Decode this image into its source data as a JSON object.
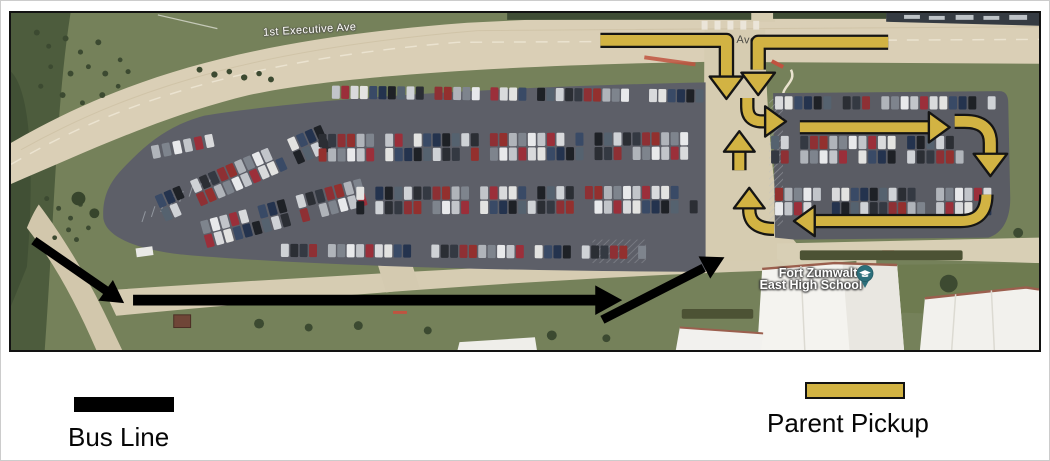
{
  "map": {
    "street_labels": [
      {
        "text": "1st Executive Ave"
      },
      {
        "text": "1st Executive Ave"
      }
    ],
    "school": {
      "line1": "Fort Zumwalt",
      "line2": "East High School",
      "pin_icon": "graduation-cap-pin",
      "pin_color": "#2c6f7b"
    }
  },
  "legend": {
    "bus": {
      "label": "Bus Line"
    },
    "parent_pickup": {
      "label": "Parent Pickup"
    }
  },
  "routes": {
    "bus_line": {
      "color": "#000000",
      "arrows": [
        {
          "name": "approach-from-west",
          "path": "M 23,233 L 97,285",
          "tip": [
            114,
            297
          ],
          "dir": 35,
          "width": 9
        },
        {
          "name": "bus-lane-eastbound",
          "path": "M 123,294 L 592,294",
          "tip": [
            616,
            294
          ],
          "dir": 0,
          "width": 11
        },
        {
          "name": "turn-toward-school",
          "path": "M 596,314 L 698,261",
          "tip": [
            719,
            250
          ],
          "dir": -27.5,
          "width": 9
        }
      ]
    },
    "parent_pickup": {
      "color": "#d2b343",
      "outline": "#151515",
      "arrows": [
        {
          "name": "entry-from-west",
          "path": "M 594,28 L 721,28 L 721,64",
          "tip": [
            721,
            88
          ],
          "dir": 90,
          "width": 11
        },
        {
          "name": "entry-from-east",
          "path": "M 884,30 L 753,30 L 753,58",
          "tip": [
            753,
            84
          ],
          "dir": 90,
          "width": 11
        },
        {
          "name": "turn-into-east-lot",
          "path": "M 742,87 L 742,96 Q 742,111 757,111 L 763,111",
          "tip": [
            781,
            111
          ],
          "dir": 0,
          "width": 10
        },
        {
          "name": "east-lot-top-aisle",
          "path": "M 795,117 L 927,117",
          "tip": [
            946,
            117
          ],
          "dir": 0,
          "width": 10
        },
        {
          "name": "turn-south-at-east-end",
          "path": "M 951,111 L 961,111 Q 987,111 987,133 L 987,147",
          "tip": [
            987,
            167
          ],
          "dir": 90,
          "width": 11
        },
        {
          "name": "east-lot-bottom-aisle",
          "path": "M 983,186 Q 983,213 957,213 L 807,213",
          "tip": [
            789,
            213
          ],
          "dir": 180,
          "width": 10
        },
        {
          "name": "turn-north-to-exit",
          "path": "M 769,221 Q 744,221 744,201 L 744,197",
          "tip": [
            744,
            179
          ],
          "dir": 270,
          "width": 10
        },
        {
          "name": "exit-to-north",
          "path": "M 734,161 L 734,139",
          "tip": [
            734,
            121
          ],
          "dir": 270,
          "width": 10
        }
      ]
    }
  }
}
